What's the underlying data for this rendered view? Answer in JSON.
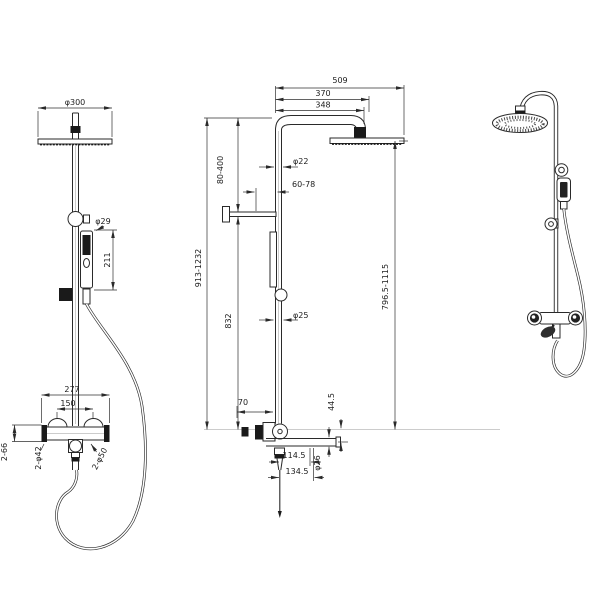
{
  "drawing": {
    "background": "#ffffff",
    "line_color": "#2a2a2a",
    "views": {
      "front": {
        "dims": {
          "head_diameter": "φ300",
          "hand_shower_diameter": "φ29",
          "hand_shower_length": "211",
          "valve_overall_width": "277",
          "valve_center_spacing": "150",
          "inlet_detail": "2-66",
          "flange_diameter": "2-φ42",
          "escutcheon_diameter": "2-φ50"
        }
      },
      "side": {
        "dims": {
          "overall_projection": "509",
          "arm_projection_outer": "370",
          "arm_projection_inner": "348",
          "riser_adjustment": "80-400",
          "riser_diameter": "φ22",
          "wall_clearance": "60-78",
          "overall_height": "913-1232",
          "riser_fixed_height": "832",
          "lower_riser_diameter": "φ25",
          "head_to_spout_height": "796.5-1115",
          "valve_depth": "70",
          "spout_drop": "44.5",
          "spout_reach_inner": "114.5",
          "spout_diameter": "φ26",
          "spout_reach_outer": "134.5"
        }
      }
    }
  }
}
